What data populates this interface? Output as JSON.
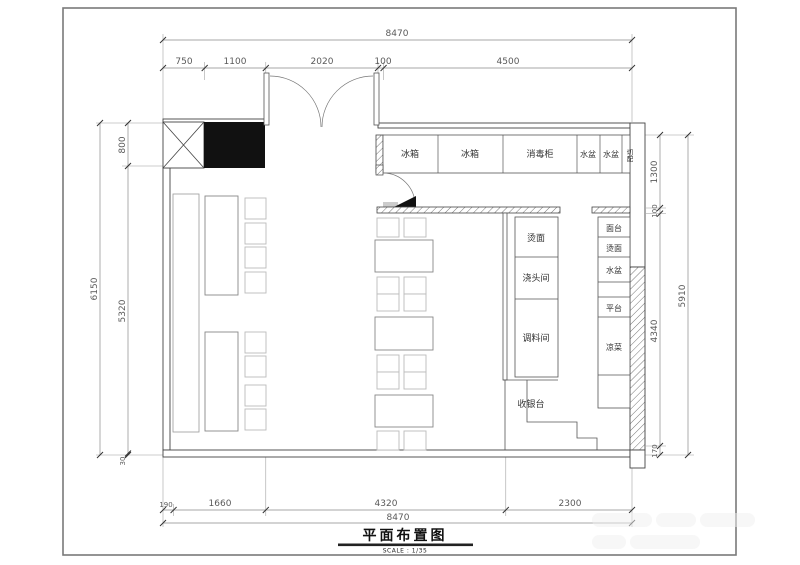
{
  "title_block": {
    "title": "平面布置图",
    "scale": "SCALE : 1/35"
  },
  "labels": {
    "top_row": [
      "冰箱",
      "冰箱",
      "消毒柜",
      "水盆",
      "水盆",
      "切配"
    ],
    "mid_rooms": [
      "烫面",
      "浇头间",
      "调料间"
    ],
    "right_counters": [
      "面台",
      "烫面",
      "水盆",
      "平台",
      "凉菜"
    ],
    "cashier": "收银台"
  },
  "dims": {
    "top": {
      "overall": "8470",
      "segments": [
        "750",
        "1100",
        "2020",
        "100",
        "4500"
      ]
    },
    "bottom": {
      "overall": "8470",
      "segments": [
        "190",
        "1660",
        "4320",
        "2300"
      ]
    },
    "left": {
      "overall": "6150",
      "segments": [
        "800",
        "5320",
        "30"
      ]
    },
    "right": {
      "overall": "5910",
      "segments": [
        "1300",
        "100",
        "4340",
        "170"
      ]
    }
  }
}
